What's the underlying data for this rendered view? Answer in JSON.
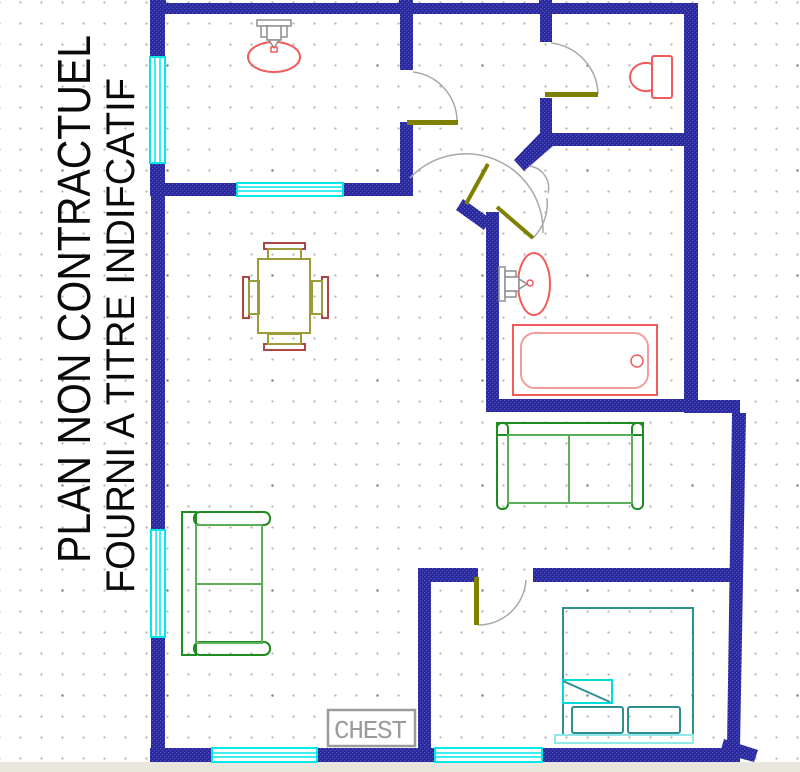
{
  "page": {
    "width": 800,
    "height": 772
  },
  "annotations": {
    "line1": "PLAN NON CONTRACTUEL",
    "line2": "FOURNI A TITRE INDIFCATIF",
    "chest_label": "CHEST"
  },
  "fixtures": {
    "top_room": [
      "sink"
    ],
    "wc": [
      "toilet"
    ],
    "bathroom": [
      "sink",
      "bathtub"
    ],
    "dining_area": [
      "table",
      "four chairs"
    ],
    "living_room": [
      "sofa",
      "loveseat"
    ],
    "bedroom": [
      "bed",
      "chest"
    ]
  },
  "colors": {
    "background": "#ffffff",
    "grid_dot": "#b3b3b3",
    "grid_dot_strong": "#8c8c8c",
    "wall_base": "#28289a",
    "wall_pattern": "#5252c4",
    "window": "#00e8e8",
    "door_leaf": "#7f7f00",
    "door_arc": "#a9a9a9",
    "fixture_red": "#f15b5b",
    "fixture_red_light": "#f49c9c",
    "faucet_gray": "#8f8f8f",
    "table_olive": "#9c9c3a",
    "chair_back_red": "#b04545",
    "sofa_green": "#1e8c1e",
    "sofa_green_light": "#5cb05c",
    "bed_teal": "#2e8f8f",
    "bed_cyan": "#00dcdc",
    "bed_base_cyan": "#90e8e8",
    "label_gray": "#9b9b9b",
    "title_black": "#0a0a0a",
    "footer_strip": "#e9e6de"
  }
}
